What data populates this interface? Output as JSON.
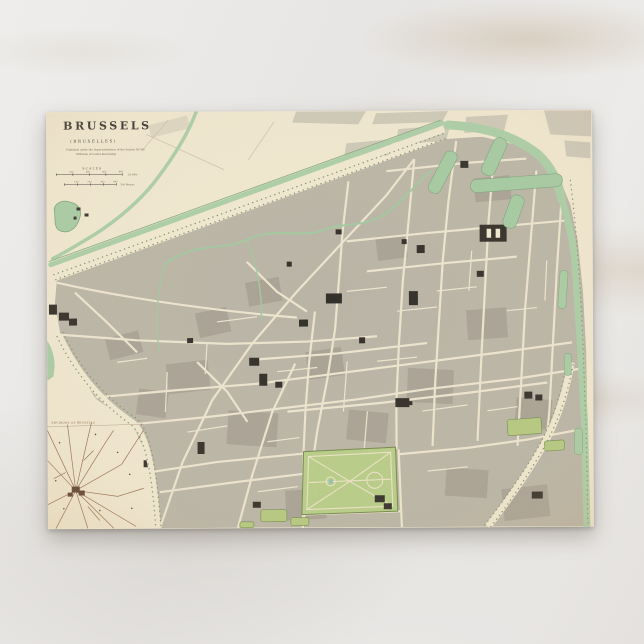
{
  "scene": {
    "surface": "white-marble-background",
    "marble_base_color": "#e9e7e5",
    "marble_vein_color": "#b29669"
  },
  "postcard": {
    "kind": "vintage-map-postcard",
    "paper_color": "#efe6cf",
    "map": {
      "title": "BRUSSELS",
      "subtitle": "(BRUXELLES)",
      "imprint_line1": "Published under the Superintendence of the Society for the",
      "imprint_line2": "Diffusion of Useful Knowledge",
      "scales": {
        "heading": "SCALES",
        "bar1_ticks": [
          "220",
          "440",
          "660",
          "880"
        ],
        "bar1_unit": "1/2 Mile",
        "bar2_ticks": [
          "100",
          "200",
          "300",
          "400"
        ],
        "bar2_unit": "500 Metres"
      },
      "inset_heading": "ENVIRONS OF BRUSSELS",
      "features": {
        "park": "Parc de Bruxelles",
        "canal_ring": "tree-lined boulevard and canal around city pentagon",
        "basins": "harbor basins (north-east docks)",
        "river": "Senne winding through centre",
        "pond": "pond outside north-west boulevard",
        "inset": "environs road map, lower left"
      },
      "colors": {
        "water_green": "#a8cba4",
        "park_green": "#b7cc87",
        "block_grey": "#bab4a6",
        "building_black": "#34302a",
        "inset_sepia": "#8a5a3e",
        "paper_cream": "#efe6cf"
      }
    }
  }
}
